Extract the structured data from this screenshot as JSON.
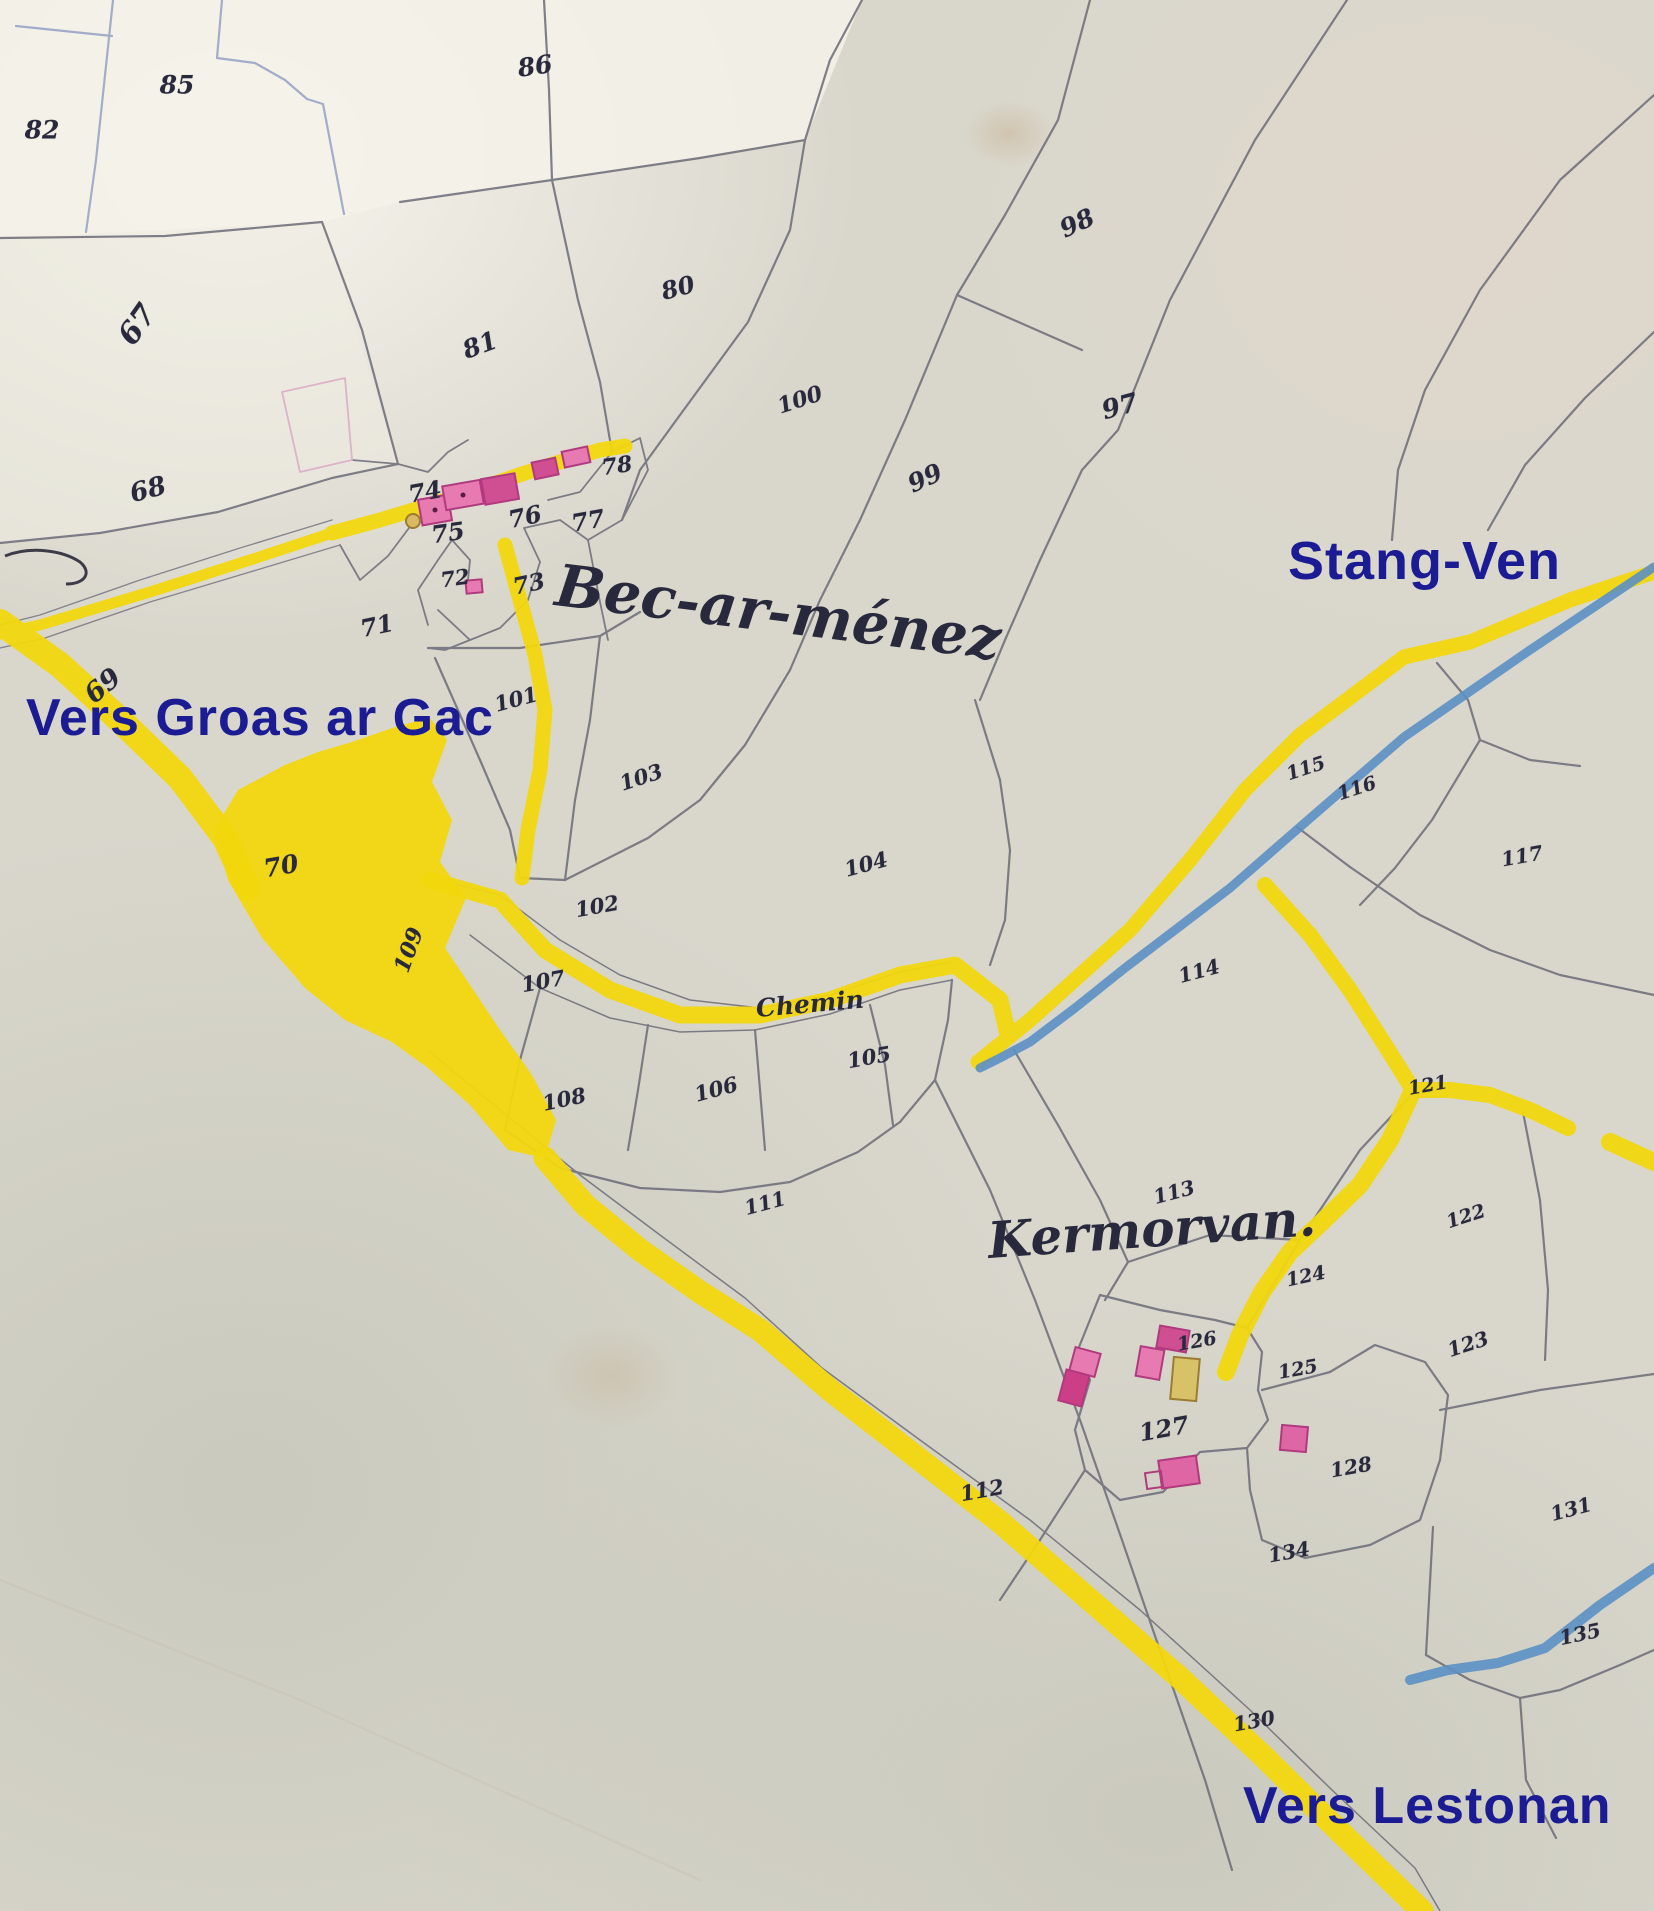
{
  "map": {
    "title": "Old cadastral map — Bec-ar-ménez / Kermorvan",
    "colors": {
      "paper": "#d9d7cc",
      "paper_light": "#f4f2e9",
      "line_gray": "#6b6b78",
      "line_blue": "#94a0c4",
      "road_yellow": "#f2d70e",
      "stream_blue": "#5b90c4",
      "building_pink": "#e87ab2",
      "building_dark_pink": "#d04f93",
      "building_tan": "#d8c268",
      "label_blue": "#1b1b94",
      "hand_ink": "#29293d"
    },
    "modern_labels": [
      {
        "id": "stang-ven",
        "text": "Stang-Ven",
        "x": 1288,
        "y": 534,
        "size": 54,
        "rotate": 0
      },
      {
        "id": "vers-groas-ar-gac",
        "text": "Vers Groas ar Gac",
        "x": 26,
        "y": 692,
        "size": 52,
        "rotate": 0
      },
      {
        "id": "vers-lestonan",
        "text": "Vers Lestonan",
        "x": 1243,
        "y": 1780,
        "size": 52,
        "rotate": 0
      }
    ],
    "place_names": [
      {
        "id": "bec-ar-menez",
        "text": "Bec-ar-ménez",
        "x": 556,
        "y": 556,
        "size": 58,
        "rotate": 7
      },
      {
        "id": "kermorvan",
        "text": "Kermorvan.",
        "x": 988,
        "y": 1216,
        "size": 50,
        "rotate": -4
      },
      {
        "id": "chemin",
        "text": "Chemin",
        "x": 756,
        "y": 996,
        "size": 25,
        "rotate": -5
      }
    ],
    "road_names": [
      "Chemin"
    ],
    "parcel_numbers": [
      {
        "n": "82",
        "x": 42,
        "y": 130,
        "r": 0,
        "s": 25
      },
      {
        "n": "85",
        "x": 177,
        "y": 85,
        "r": 0,
        "s": 25
      },
      {
        "n": "86",
        "x": 535,
        "y": 66,
        "r": -8,
        "s": 25
      },
      {
        "n": "67",
        "x": 138,
        "y": 325,
        "r": -55,
        "s": 30
      },
      {
        "n": "68",
        "x": 148,
        "y": 490,
        "r": -15,
        "s": 26
      },
      {
        "n": "81",
        "x": 480,
        "y": 345,
        "r": -20,
        "s": 25
      },
      {
        "n": "80",
        "x": 678,
        "y": 288,
        "r": -15,
        "s": 24
      },
      {
        "n": "98",
        "x": 1077,
        "y": 223,
        "r": -25,
        "s": 25
      },
      {
        "n": "100",
        "x": 800,
        "y": 400,
        "r": -18,
        "s": 22
      },
      {
        "n": "97",
        "x": 1120,
        "y": 407,
        "r": -15,
        "s": 26
      },
      {
        "n": "99",
        "x": 925,
        "y": 478,
        "r": -25,
        "s": 25
      },
      {
        "n": "74",
        "x": 425,
        "y": 492,
        "r": -10,
        "s": 24
      },
      {
        "n": "75",
        "x": 448,
        "y": 533,
        "r": -8,
        "s": 24
      },
      {
        "n": "76",
        "x": 525,
        "y": 517,
        "r": -12,
        "s": 24
      },
      {
        "n": "77",
        "x": 588,
        "y": 521,
        "r": -10,
        "s": 24
      },
      {
        "n": "78",
        "x": 617,
        "y": 466,
        "r": -8,
        "s": 22
      },
      {
        "n": "72",
        "x": 455,
        "y": 578,
        "r": -8,
        "s": 21
      },
      {
        "n": "73",
        "x": 529,
        "y": 584,
        "r": -12,
        "s": 23
      },
      {
        "n": "71",
        "x": 377,
        "y": 626,
        "r": -12,
        "s": 24
      },
      {
        "n": "69",
        "x": 103,
        "y": 686,
        "r": -40,
        "s": 27
      },
      {
        "n": "70",
        "x": 281,
        "y": 866,
        "r": -10,
        "s": 25
      },
      {
        "n": "101",
        "x": 516,
        "y": 699,
        "r": -15,
        "s": 21
      },
      {
        "n": "103",
        "x": 641,
        "y": 777,
        "r": -18,
        "s": 21
      },
      {
        "n": "104",
        "x": 866,
        "y": 864,
        "r": -15,
        "s": 21
      },
      {
        "n": "102",
        "x": 597,
        "y": 906,
        "r": -10,
        "s": 21
      },
      {
        "n": "109",
        "x": 409,
        "y": 950,
        "r": -70,
        "s": 22
      },
      {
        "n": "107",
        "x": 543,
        "y": 981,
        "r": -10,
        "s": 21
      },
      {
        "n": "108",
        "x": 564,
        "y": 1099,
        "r": -12,
        "s": 21
      },
      {
        "n": "106",
        "x": 716,
        "y": 1089,
        "r": -15,
        "s": 21
      },
      {
        "n": "105",
        "x": 869,
        "y": 1057,
        "r": -10,
        "s": 21
      },
      {
        "n": "115",
        "x": 1306,
        "y": 769,
        "r": -18,
        "s": 19
      },
      {
        "n": "116",
        "x": 1357,
        "y": 789,
        "r": -18,
        "s": 19
      },
      {
        "n": "117",
        "x": 1522,
        "y": 856,
        "r": -10,
        "s": 20
      },
      {
        "n": "114",
        "x": 1199,
        "y": 971,
        "r": -15,
        "s": 20
      },
      {
        "n": "113",
        "x": 1174,
        "y": 1192,
        "r": -15,
        "s": 20
      },
      {
        "n": "111",
        "x": 765,
        "y": 1203,
        "r": -15,
        "s": 20
      },
      {
        "n": "121",
        "x": 1428,
        "y": 1086,
        "r": -10,
        "s": 19
      },
      {
        "n": "122",
        "x": 1466,
        "y": 1217,
        "r": -18,
        "s": 19
      },
      {
        "n": "124",
        "x": 1306,
        "y": 1277,
        "r": -12,
        "s": 19
      },
      {
        "n": "123",
        "x": 1468,
        "y": 1344,
        "r": -18,
        "s": 20
      },
      {
        "n": "126",
        "x": 1197,
        "y": 1342,
        "r": -10,
        "s": 19
      },
      {
        "n": "125",
        "x": 1298,
        "y": 1370,
        "r": -10,
        "s": 19
      },
      {
        "n": "127",
        "x": 1164,
        "y": 1429,
        "r": -10,
        "s": 24
      },
      {
        "n": "128",
        "x": 1351,
        "y": 1467,
        "r": -10,
        "s": 20
      },
      {
        "n": "112",
        "x": 982,
        "y": 1490,
        "r": -10,
        "s": 21
      },
      {
        "n": "134",
        "x": 1289,
        "y": 1552,
        "r": -10,
        "s": 20
      },
      {
        "n": "131",
        "x": 1571,
        "y": 1509,
        "r": -15,
        "s": 20
      },
      {
        "n": "135",
        "x": 1580,
        "y": 1634,
        "r": -12,
        "s": 20
      },
      {
        "n": "130",
        "x": 1254,
        "y": 1721,
        "r": -10,
        "s": 20
      }
    ]
  }
}
